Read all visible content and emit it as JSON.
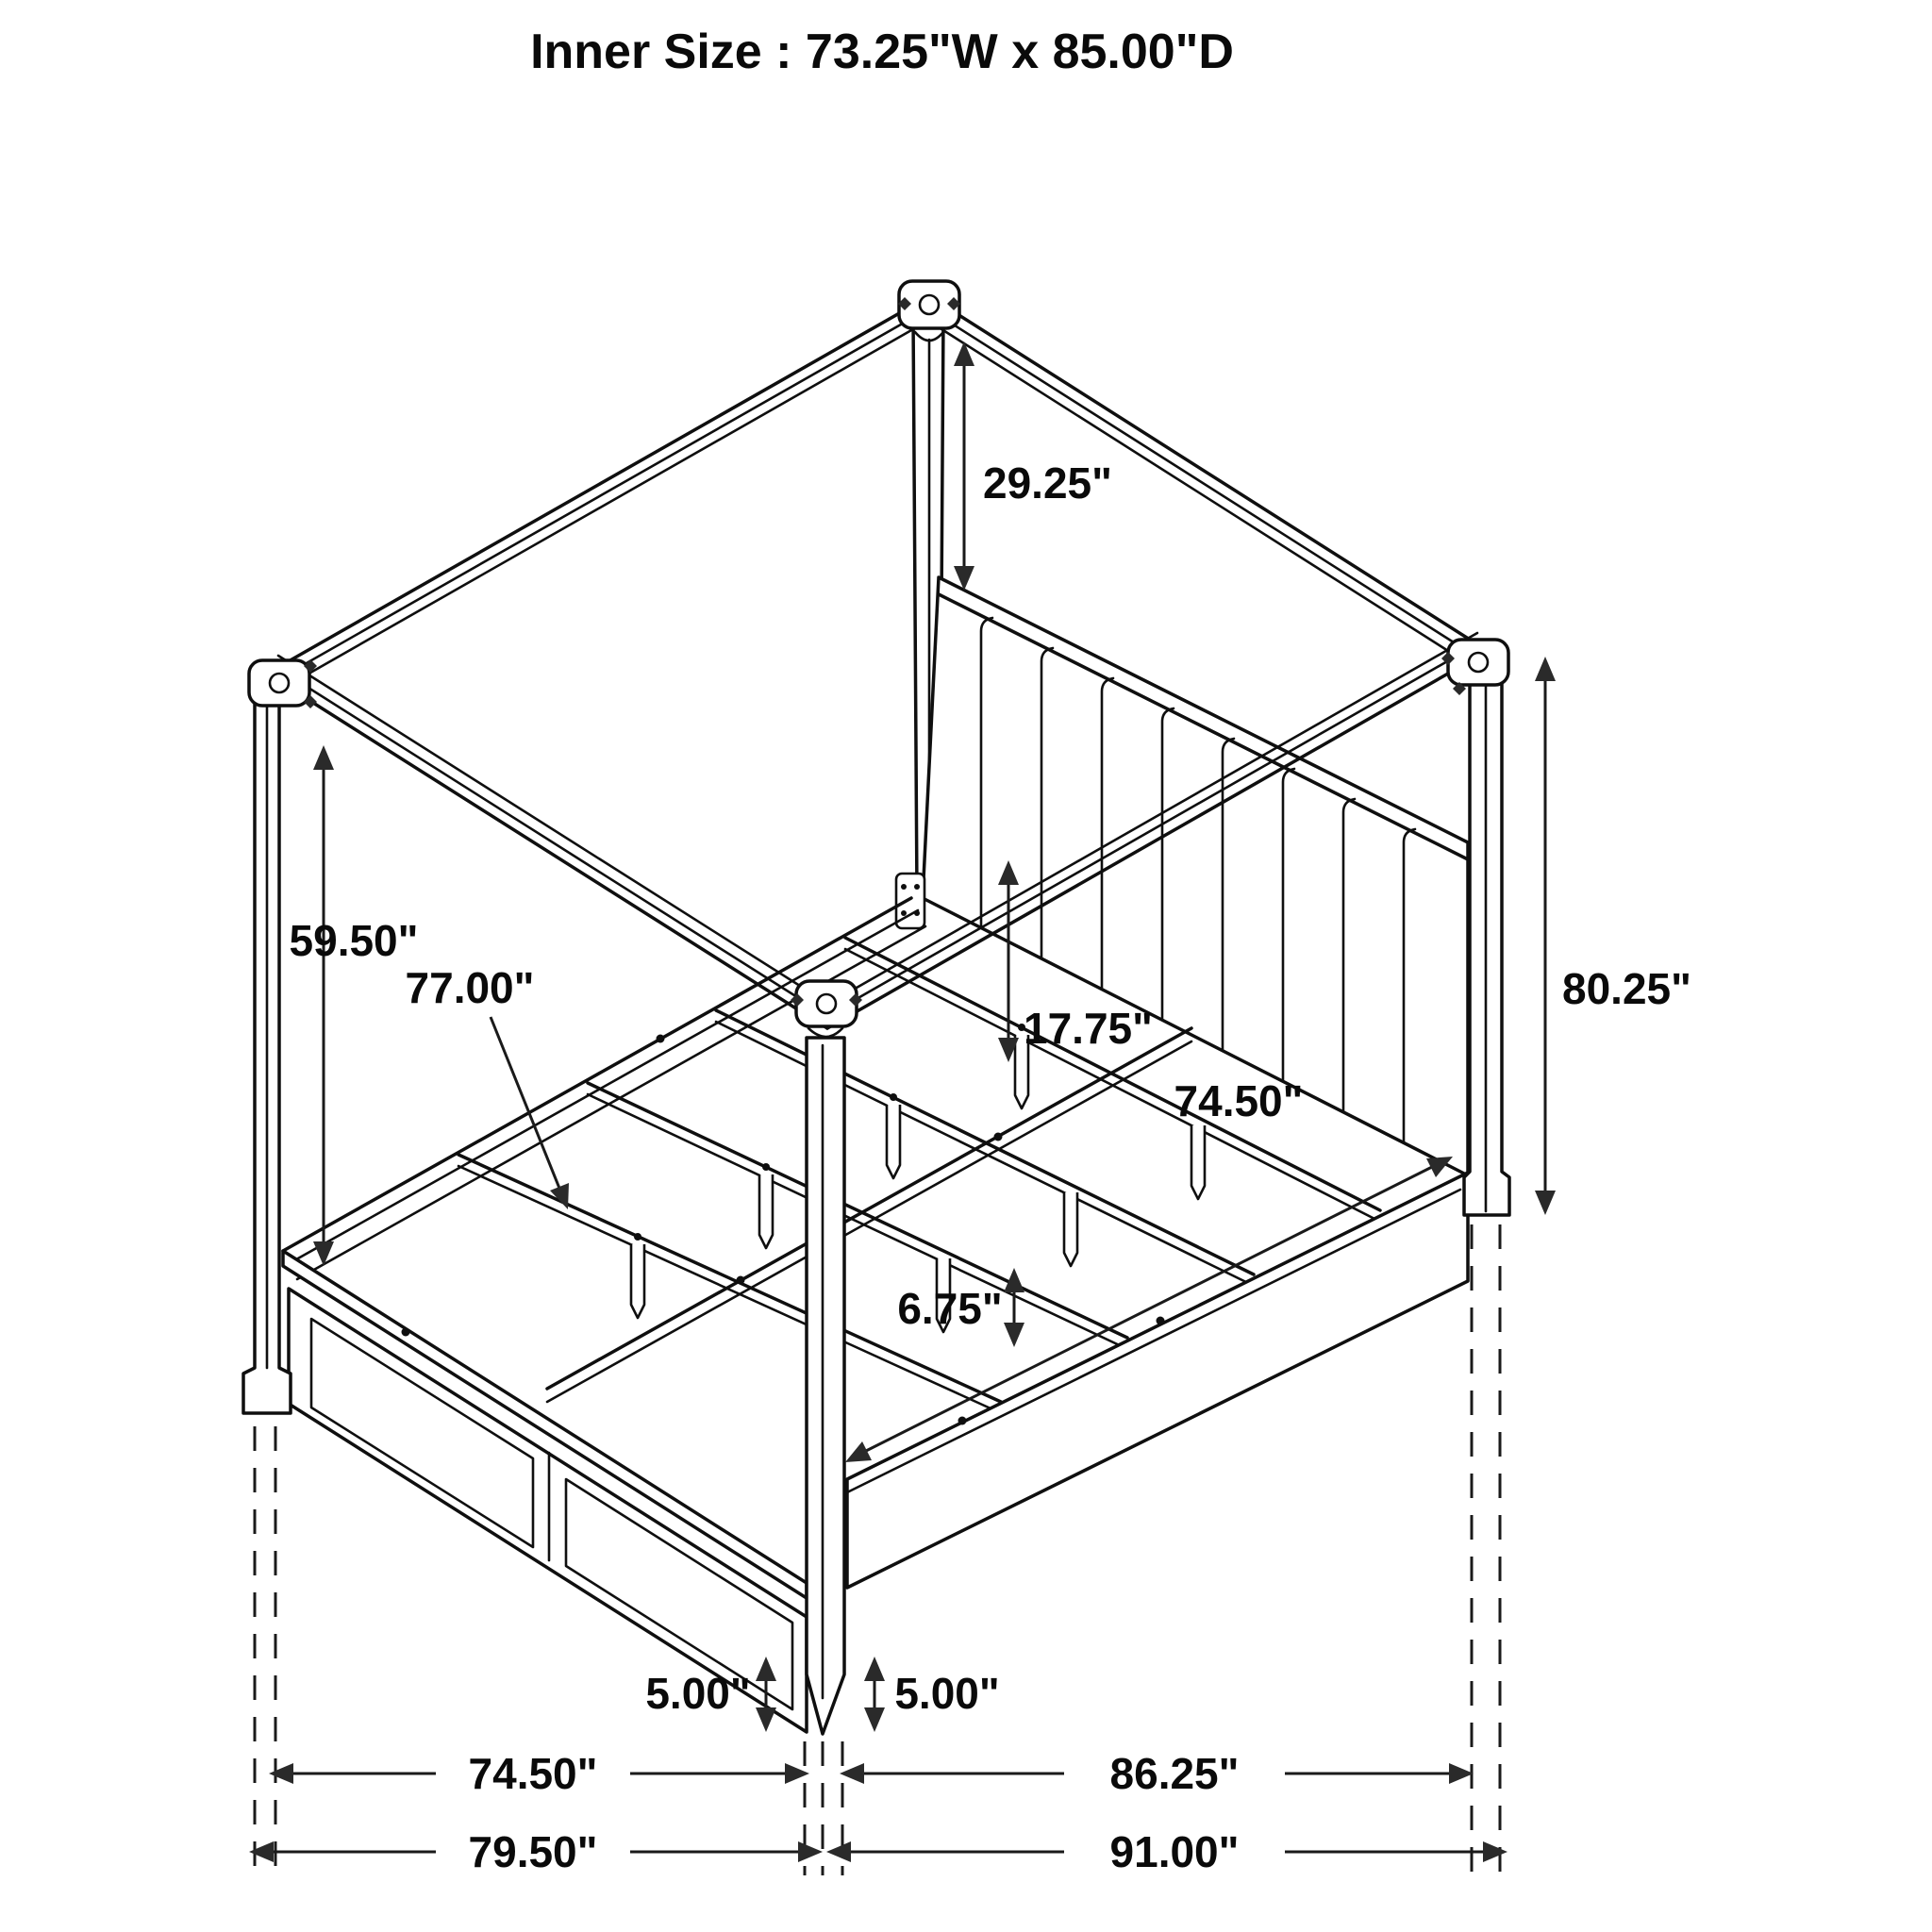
{
  "header": {
    "title": "Inner Size : 73.25\"W x 85.00\"D"
  },
  "drawing": {
    "type": "isometric-wireframe-dimension-diagram",
    "subject": "four-poster canopy bed frame with upholstered channel headboard, slat supports and footboard drawers",
    "dimensions": {
      "canopy_top_to_headboard_top": "29.25\"",
      "canopy_underside_to_footboard_rail": "59.50\"",
      "slat_length": "77.00\"",
      "headboard_shelf_to_slat_drop": "17.75\"",
      "side_rail_length": "74.50\"",
      "overall_post_height": "80.25\"",
      "slat_to_rail_bottom": "6.75\"",
      "front_foot_height": "5.00\"",
      "center_foot_height": "5.00\"",
      "footboard_outer_width": "74.50\"",
      "side_outer_length": "86.25\"",
      "overall_width": "79.50\"",
      "overall_depth": "91.00\""
    }
  }
}
